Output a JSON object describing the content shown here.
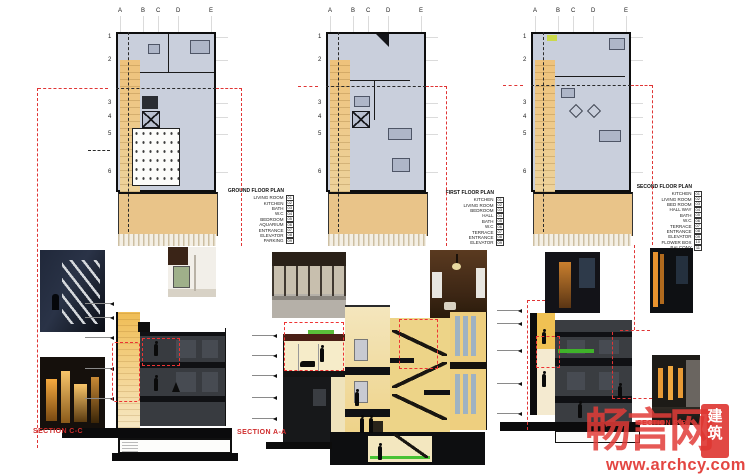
{
  "plans": [
    {
      "title": "GROUND FLOOR PLAN",
      "grid_letters": [
        "A",
        "B",
        "C",
        "D",
        "E"
      ],
      "grid_numbers": [
        "1",
        "2",
        "3",
        "4",
        "5",
        "6"
      ],
      "legend": [
        {
          "label": "LIVING ROOM",
          "num": "01"
        },
        {
          "label": "KITCHEN",
          "num": "02"
        },
        {
          "label": "BATH",
          "num": "03"
        },
        {
          "label": "W.C",
          "num": "04"
        },
        {
          "label": "BEDROOM",
          "num": "05"
        },
        {
          "label": "AQUARIUM",
          "num": "06"
        },
        {
          "label": "ENTRANCE",
          "num": "07"
        },
        {
          "label": "ELEVATOR",
          "num": "08"
        },
        {
          "label": "PARKING",
          "num": "09"
        }
      ]
    },
    {
      "title": "FIRST FLOOR PLAN",
      "grid_letters": [
        "A",
        "B",
        "C",
        "D",
        "E"
      ],
      "grid_numbers": [
        "1",
        "2",
        "3",
        "4",
        "5",
        "6"
      ],
      "legend": [
        {
          "label": "KITCHEN",
          "num": "01"
        },
        {
          "label": "LIVING ROOM",
          "num": "02"
        },
        {
          "label": "BEDROOM",
          "num": "03"
        },
        {
          "label": "HALL",
          "num": "04"
        },
        {
          "label": "BATH",
          "num": "05"
        },
        {
          "label": "W.C",
          "num": "06"
        },
        {
          "label": "TERRACE",
          "num": "07"
        },
        {
          "label": "ENTRANCE",
          "num": "08"
        },
        {
          "label": "ELEVATOR",
          "num": "09"
        }
      ]
    },
    {
      "title": "SECOND FLOOR PLAN",
      "grid_letters": [
        "A",
        "B",
        "C",
        "D",
        "E"
      ],
      "grid_numbers": [
        "1",
        "2",
        "3",
        "4",
        "5",
        "6"
      ],
      "legend": [
        {
          "label": "KITCHEN",
          "num": "01"
        },
        {
          "label": "LIVING ROOM",
          "num": "02"
        },
        {
          "label": "BED ROOM",
          "num": "03"
        },
        {
          "label": "HALL WAY",
          "num": "04"
        },
        {
          "label": "BATH",
          "num": "05"
        },
        {
          "label": "W.C",
          "num": "06"
        },
        {
          "label": "TERRACE",
          "num": "07"
        },
        {
          "label": "ENTRANCE",
          "num": "08"
        },
        {
          "label": "ELEVATOR",
          "num": "09"
        },
        {
          "label": "FLOWER BOX",
          "num": "10"
        },
        {
          "label": "BALCONY",
          "num": "11"
        }
      ]
    }
  ],
  "sections": [
    {
      "label": "SECTION C-C"
    },
    {
      "label": "SECTION A-A"
    },
    {
      "label": "SECTION B-B"
    }
  ],
  "watermark": {
    "logo": "畅言网",
    "seal": "建筑",
    "url": "www.archcy.com"
  },
  "colors": {
    "plan_fill": "#c9cfdc",
    "accent_tan": "#ecc27e",
    "courtyard_tan": "#e9c489",
    "section_dark": "#3a3d41",
    "section_cream": "#f0dfae",
    "highlight_red": "#e03535",
    "green_accent": "#49c234",
    "watermark_red": "#e23c3c"
  }
}
